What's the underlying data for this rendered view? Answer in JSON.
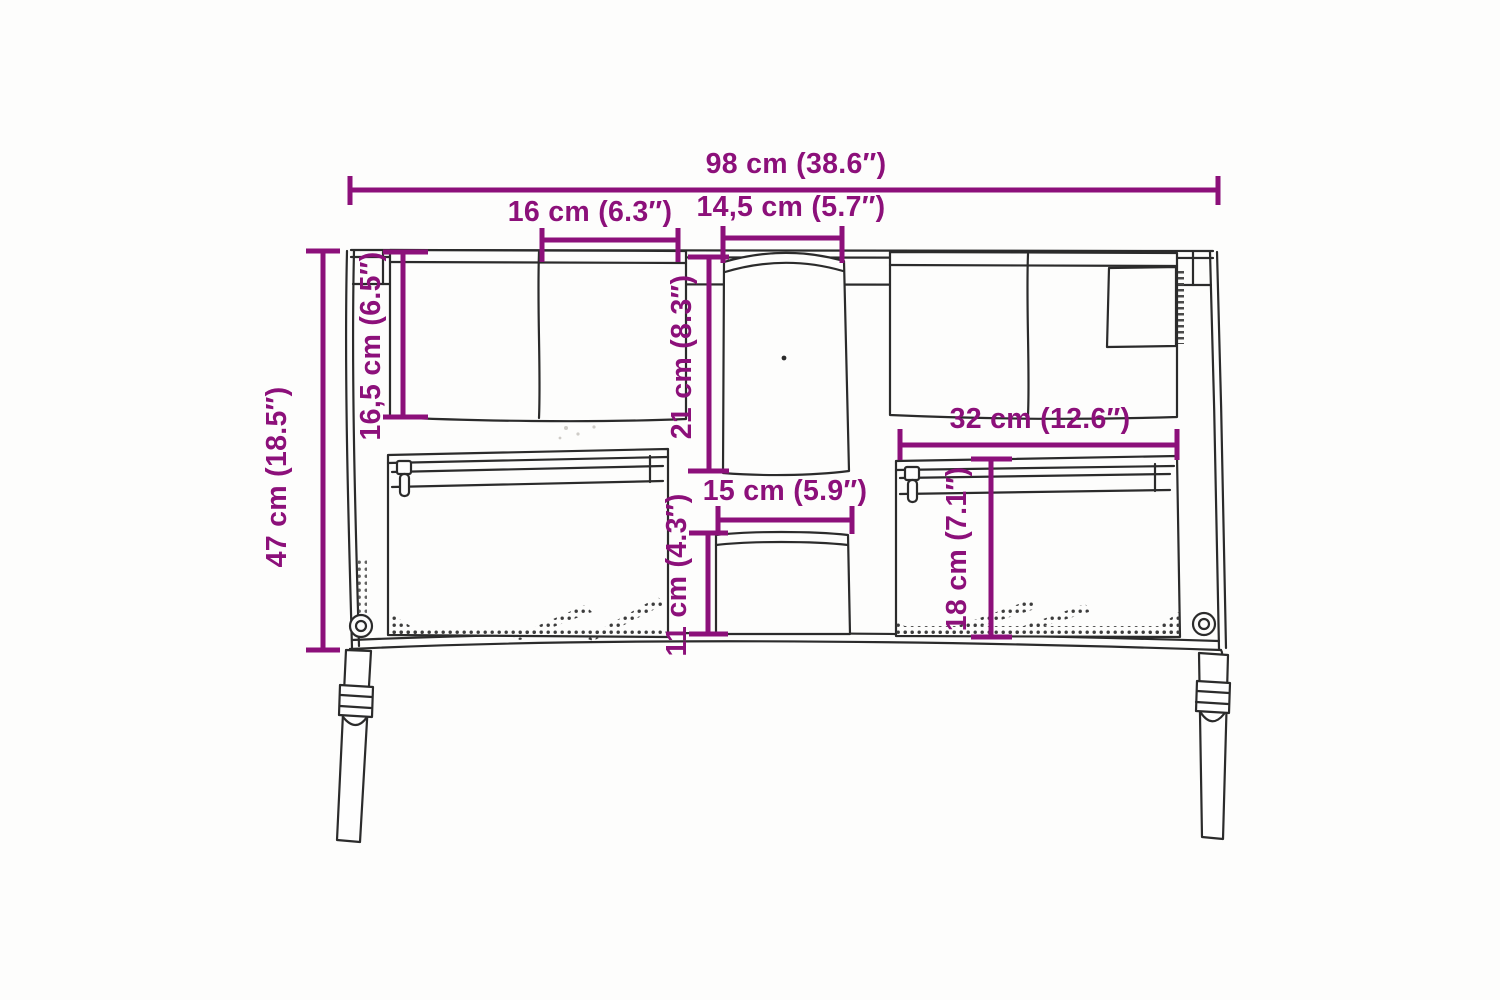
{
  "diagram": {
    "kind": "product-dimension-diagram",
    "colors": {
      "dimension_accent": "#8C107A",
      "drawing_line": "#2b2b2b",
      "background": "#fdfdfc"
    },
    "dimensions": {
      "total_width": {
        "label": "98 cm (38.6″)"
      },
      "top_left_pocket_width": {
        "label": "16 cm (6.3″)"
      },
      "top_center_pocket_width": {
        "label": "14,5 cm (5.7″)"
      },
      "top_left_pocket_depth": {
        "label": "16,5 cm (6.5″)"
      },
      "total_height": {
        "label": "47 cm (18.5″)"
      },
      "center_pocket_depth": {
        "label": "21 cm (8.3″)"
      },
      "bottom_center_pocket_width": {
        "label": "15 cm (5.9″)"
      },
      "bottom_center_pocket_depth": {
        "label": "11 cm (4.3″)"
      },
      "right_zip_pocket_width": {
        "label": "32 cm (12.6″)"
      },
      "right_zip_pocket_depth": {
        "label": "18 cm (7.1″)"
      }
    }
  }
}
